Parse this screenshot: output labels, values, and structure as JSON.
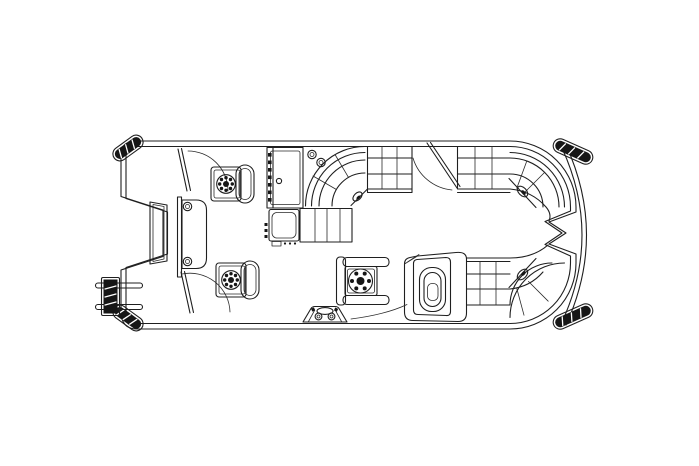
{
  "document": {
    "kind": "boat floor plan diagram",
    "subject": "Pontoon boat deck layout, overhead plan view",
    "background_color": "#ffffff",
    "line_color": "#1f1f1f",
    "accent_fill_color": "#161616",
    "visible_text": ""
  },
  "parts": {
    "hull": "Pontoon hull fence and deck outline",
    "bow_cap_port": "Port bow pontoon nose cap",
    "bow_cap_stbd": "Starboard bow pontoon nose cap",
    "stern_cap_port": "Port stern pontoon cap",
    "stern_cap_stbd": "Starboard stern pontoon cap",
    "stern_deck": "Rear deck edge arc",
    "boarding_ladder": "Folded bow boarding ladder",
    "bow_gate": "Bow center boarding gate",
    "bow_divider": "Bow deck divider wall",
    "bow_table": "Bow table with cup holders",
    "gate_stbd_fwd": "Starboard forward gate with swing arc",
    "gate_port_fwd": "Port forward gate with swing arc",
    "chair_stbd": "Starboard pedestal fishing chair",
    "chair_port": "Port pedestal fishing chair",
    "galley": "Galley / storage console with sink cabinet",
    "cup_holders": "Deck cup holders",
    "corner_lounge": "Curved corner lounge seat",
    "bench_stbd_fwd": "Starboard forward bench seat",
    "gate_stbd_aft": "Starboard aft boarding gate with swing arc",
    "bench_stbd_aft": "Starboard aft wrap-around lounge",
    "bench_port_aft": "Port aft wrap-around lounge",
    "stern_notch": "Stern motor-well notch",
    "helm_console": "Helm console with steering wheel",
    "captain_chair": "Captain's helm chair",
    "deck_step": "Deck step / speaker pod"
  }
}
